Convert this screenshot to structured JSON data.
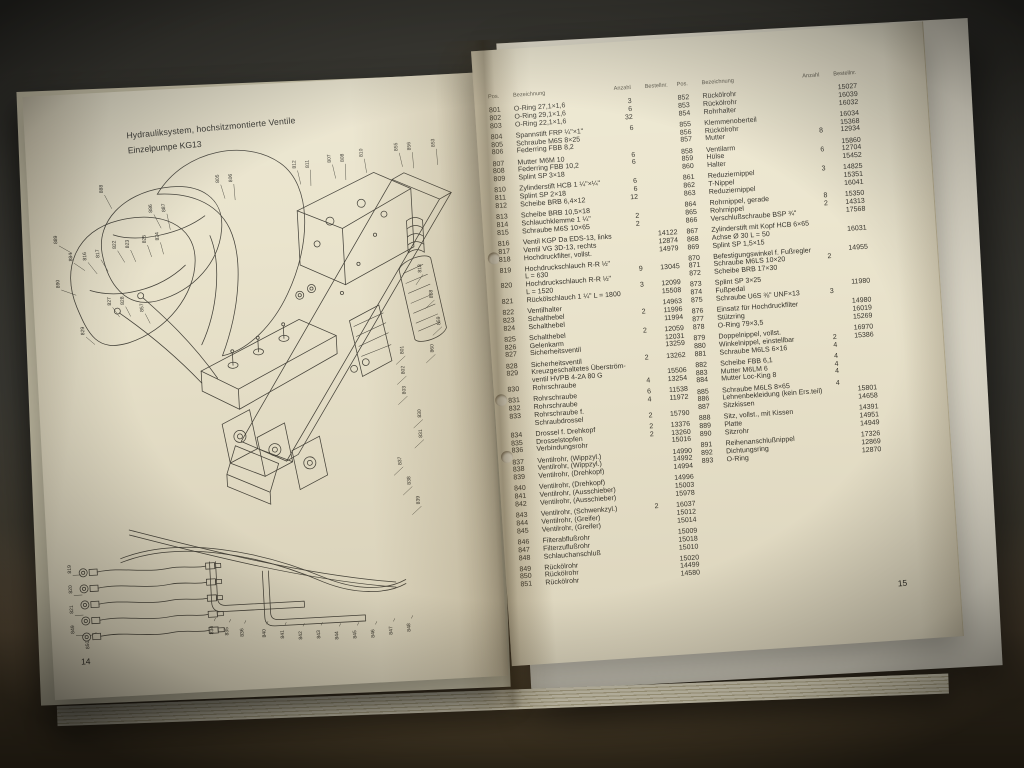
{
  "photo": {
    "background_color": "#3c3b35",
    "table_surface_color": "#6b5a42",
    "page_color": "#eae4cd"
  },
  "left_page": {
    "heading_line1": "Hydrauliksystem, hochsitzmontierte Ventile",
    "heading_line2": "Einzelpumpe KG13",
    "page_number": "14",
    "diagram_callouts": [
      {
        "x": 62,
        "y": 56,
        "t": "888",
        "lx": 8,
        "ly": 16
      },
      {
        "x": 110,
        "y": 78,
        "t": "886",
        "lx": 8,
        "ly": 16
      },
      {
        "x": 123,
        "y": 78,
        "t": "887",
        "lx": 4,
        "ly": 18
      },
      {
        "x": 178,
        "y": 52,
        "t": "805",
        "lx": 5,
        "ly": 16
      },
      {
        "x": 191,
        "y": 52,
        "t": "806",
        "lx": 2,
        "ly": 18
      },
      {
        "x": 255,
        "y": 42,
        "t": "812",
        "lx": 4,
        "ly": 16
      },
      {
        "x": 268,
        "y": 42,
        "t": "811",
        "lx": 1,
        "ly": 18
      },
      {
        "x": 290,
        "y": 38,
        "t": "807",
        "lx": 4,
        "ly": 16
      },
      {
        "x": 303,
        "y": 38,
        "t": "808",
        "lx": 1,
        "ly": 18
      },
      {
        "x": 322,
        "y": 34,
        "t": "810",
        "lx": 3,
        "ly": 16
      },
      {
        "x": 357,
        "y": 30,
        "t": "855",
        "lx": 4,
        "ly": 16
      },
      {
        "x": 370,
        "y": 30,
        "t": "856",
        "lx": 2,
        "ly": 18
      },
      {
        "x": 394,
        "y": 28,
        "t": "853",
        "lx": 2,
        "ly": 18
      },
      {
        "x": 14,
        "y": 104,
        "t": "889",
        "lx": 14,
        "ly": 10
      },
      {
        "x": 14,
        "y": 148,
        "t": "890",
        "lx": 16,
        "ly": 8
      },
      {
        "x": 28,
        "y": 122,
        "t": "884",
        "lx": 12,
        "ly": 10
      },
      {
        "x": 42,
        "y": 122,
        "t": "816",
        "lx": 10,
        "ly": 14
      },
      {
        "x": 55,
        "y": 120,
        "t": "817",
        "lx": 8,
        "ly": 14
      },
      {
        "x": 72,
        "y": 112,
        "t": "822",
        "lx": 8,
        "ly": 14
      },
      {
        "x": 85,
        "y": 112,
        "t": "823",
        "lx": 6,
        "ly": 14
      },
      {
        "x": 102,
        "y": 108,
        "t": "825",
        "lx": 5,
        "ly": 14
      },
      {
        "x": 115,
        "y": 106,
        "t": "824",
        "lx": 4,
        "ly": 14
      },
      {
        "x": 64,
        "y": 168,
        "t": "827",
        "lx": 8,
        "ly": 12
      },
      {
        "x": 77,
        "y": 168,
        "t": "828",
        "lx": 6,
        "ly": 12
      },
      {
        "x": 96,
        "y": 176,
        "t": "857",
        "lx": 6,
        "ly": 12
      },
      {
        "x": 36,
        "y": 196,
        "t": "829",
        "lx": 10,
        "ly": 10
      },
      {
        "x": 374,
        "y": 152,
        "t": "818",
        "lx": -6,
        "ly": 12
      },
      {
        "x": 384,
        "y": 178,
        "t": "858",
        "lx": -8,
        "ly": 10
      },
      {
        "x": 390,
        "y": 205,
        "t": "859",
        "lx": -8,
        "ly": 10
      },
      {
        "x": 382,
        "y": 232,
        "t": "860",
        "lx": -8,
        "ly": 10
      },
      {
        "x": 352,
        "y": 232,
        "t": "801",
        "lx": -8,
        "ly": 10
      },
      {
        "x": 352,
        "y": 252,
        "t": "802",
        "lx": -8,
        "ly": 10
      },
      {
        "x": 352,
        "y": 272,
        "t": "803",
        "lx": -8,
        "ly": 10
      },
      {
        "x": 366,
        "y": 296,
        "t": "830",
        "lx": -8,
        "ly": 10
      },
      {
        "x": 366,
        "y": 316,
        "t": "831",
        "lx": -8,
        "ly": 10
      },
      {
        "x": 344,
        "y": 342,
        "t": "837",
        "lx": -8,
        "ly": 10
      },
      {
        "x": 352,
        "y": 362,
        "t": "838",
        "lx": -8,
        "ly": 10
      },
      {
        "x": 360,
        "y": 382,
        "t": "839",
        "lx": -8,
        "ly": 10
      },
      {
        "x": 10,
        "y": 432,
        "t": "819",
        "lx": 10,
        "ly": 2
      },
      {
        "x": 10,
        "y": 452,
        "t": "820",
        "lx": 10,
        "ly": 2
      },
      {
        "x": 10,
        "y": 472,
        "t": "821",
        "lx": 10,
        "ly": 2
      },
      {
        "x": 10,
        "y": 492,
        "t": "849",
        "lx": 10,
        "ly": 2
      },
      {
        "x": 24,
        "y": 508,
        "t": "850",
        "lx": 8,
        "ly": -16
      },
      {
        "x": 148,
        "y": 500,
        "t": "834",
        "lx": 3,
        "ly": -16
      },
      {
        "x": 163,
        "y": 502,
        "t": "835",
        "lx": 3,
        "ly": -16
      },
      {
        "x": 178,
        "y": 504,
        "t": "836",
        "lx": 3,
        "ly": -16
      },
      {
        "x": 200,
        "y": 506,
        "t": "840",
        "lx": 3,
        "ly": -16
      },
      {
        "x": 218,
        "y": 508,
        "t": "841",
        "lx": 3,
        "ly": -16
      },
      {
        "x": 236,
        "y": 510,
        "t": "842",
        "lx": 3,
        "ly": -16
      },
      {
        "x": 254,
        "y": 510,
        "t": "843",
        "lx": 3,
        "ly": -16
      },
      {
        "x": 272,
        "y": 512,
        "t": "844",
        "lx": 3,
        "ly": -16
      },
      {
        "x": 290,
        "y": 512,
        "t": "845",
        "lx": 3,
        "ly": -16
      },
      {
        "x": 308,
        "y": 512,
        "t": "846",
        "lx": 3,
        "ly": -16
      },
      {
        "x": 326,
        "y": 510,
        "t": "847",
        "lx": 3,
        "ly": -16
      },
      {
        "x": 344,
        "y": 508,
        "t": "848",
        "lx": 3,
        "ly": -16
      }
    ]
  },
  "right_page": {
    "page_number": "15",
    "table": {
      "headers": {
        "pos": "Pos.",
        "name": "Bezeichnung",
        "qty": "Anzahl",
        "no": "Bestellnr."
      },
      "col1_groups": [
        [
          [
            "801",
            "O-Ring 27,1×1,6",
            "",
            "3",
            ""
          ],
          [
            "802",
            "O-Ring 29,1×1,6",
            "",
            "6",
            ""
          ],
          [
            "803",
            "O-Ring 22,1×1,6",
            "",
            "32",
            ""
          ]
        ],
        [
          [
            "804",
            "Spannstift FRP ¼\"×1\"",
            "",
            "6",
            ""
          ],
          [
            "805",
            "Schraube M6S 8×25",
            "",
            "",
            ""
          ],
          [
            "806",
            "Federring FBB 8,2",
            "",
            "",
            ""
          ]
        ],
        [
          [
            "807",
            "Mutter M6M 10",
            "",
            "6",
            ""
          ],
          [
            "808",
            "Federring FBB 10,2",
            "",
            "6",
            ""
          ],
          [
            "809",
            "Splint SP 3×18",
            "",
            "",
            ""
          ]
        ],
        [
          [
            "810",
            "Zylinderstift HCB 1 ¼\"×¼\"",
            "",
            "6",
            ""
          ],
          [
            "811",
            "Splint SP 2×18",
            "",
            "6",
            ""
          ],
          [
            "812",
            "Scheibe BRB 6,4×12",
            "",
            "12",
            ""
          ]
        ],
        [
          [
            "813",
            "Scheibe BRB 10,5×18",
            "",
            "",
            ""
          ],
          [
            "814",
            "Schlauchklemme 1 ¼\"",
            "",
            "2",
            ""
          ],
          [
            "815",
            "Schraube M6S 10×65",
            "",
            "2",
            ""
          ]
        ],
        [
          [
            "816",
            "Ventil KGP Da EDS-13, links",
            "",
            "",
            "14122"
          ],
          [
            "817",
            "Ventil VG 3D-13, rechts",
            "",
            "",
            "12874"
          ],
          [
            "818",
            "Hochdruckfilter, vollst.",
            "",
            "",
            "14979"
          ]
        ],
        [
          [
            "819",
            "Hochdruckschlauch R-R ½\"",
            "L = 630",
            "9",
            "13045"
          ],
          [
            "820",
            "Hochdruckschlauch R-R ½\"",
            "L = 1520",
            "3",
            "12099"
          ],
          [
            "821",
            "Rückölschlauch 1 ¼\" L = 1800",
            "",
            "",
            "15508"
          ]
        ],
        [
          [
            "822",
            "Ventilhalter",
            "",
            "",
            "14963"
          ],
          [
            "823",
            "Schalthebel",
            "",
            "2",
            "11996"
          ],
          [
            "824",
            "Schalthebel",
            "",
            "",
            "11994"
          ]
        ],
        [
          [
            "825",
            "Schalthebel",
            "",
            "2",
            "12059"
          ],
          [
            "826",
            "Gelenkarm",
            "",
            "",
            "12031"
          ],
          [
            "827",
            "Sicherheitsventil",
            "",
            "",
            "13259"
          ]
        ],
        [
          [
            "828",
            "Sicherheitsventil",
            "",
            "2",
            "13262"
          ],
          [
            "829",
            "Kreuzgeschaltetes Überström-",
            "ventil HVPB 4-2A 80 G",
            "",
            "15506"
          ],
          [
            "830",
            "Rohrschraube",
            "",
            "4",
            "13254"
          ]
        ],
        [
          [
            "831",
            "Rohrschraube",
            "",
            "6",
            "11538"
          ],
          [
            "832",
            "Rohrschraube",
            "",
            "4",
            "11972"
          ],
          [
            "833",
            "Rohrschraube f.",
            "Schraubdrossel",
            "2",
            "15790"
          ]
        ],
        [
          [
            "834",
            "Drossel f. Drehkopf",
            "",
            "2",
            "13376"
          ],
          [
            "835",
            "Drosselstopfen",
            "",
            "2",
            "13260"
          ],
          [
            "836",
            "Verbindungsrohr",
            "",
            "",
            "15016"
          ]
        ],
        [
          [
            "837",
            "Ventilrohr, (Wippzyl.)",
            "",
            "",
            "14990"
          ],
          [
            "838",
            "Ventilrohr, (Wippzyl.)",
            "",
            "",
            "14992"
          ],
          [
            "839",
            "Ventilrohr, (Drehkopf)",
            "",
            "",
            "14994"
          ]
        ],
        [
          [
            "840",
            "Ventilrohr, (Drehkopf)",
            "",
            "",
            "14996"
          ],
          [
            "841",
            "Ventilrohr, (Ausschieber)",
            "",
            "",
            "15003"
          ],
          [
            "842",
            "Ventilrohr, (Ausschieber)",
            "",
            "",
            "15978"
          ]
        ],
        [
          [
            "843",
            "Ventilrohr, (Schwenkzyl.)",
            "",
            "2",
            "16037"
          ],
          [
            "844",
            "Ventilrohr, (Greifer)",
            "",
            "",
            "15012"
          ],
          [
            "845",
            "Ventilrohr, (Greifer)",
            "",
            "",
            "15014"
          ]
        ],
        [
          [
            "846",
            "Filterabflußrohr",
            "",
            "",
            "15009"
          ],
          [
            "847",
            "Filterzuflußrohr",
            "",
            "",
            "15018"
          ],
          [
            "848",
            "Schlauchanschluß",
            "",
            "",
            "15010"
          ]
        ],
        [
          [
            "849",
            "Rückölrohr",
            "",
            "",
            "15020"
          ],
          [
            "850",
            "Rückölrohr",
            "",
            "",
            "14499"
          ],
          [
            "851",
            "Rückölrohr",
            "",
            "",
            "14580"
          ]
        ]
      ],
      "col2_groups": [
        [
          [
            "852",
            "Rückölrohr",
            "",
            "",
            "15027"
          ],
          [
            "853",
            "Rückölrohr",
            "",
            "",
            "16039"
          ],
          [
            "854",
            "Rohrhalter",
            "",
            "",
            "16032"
          ]
        ],
        [
          [
            "855",
            "Klemmenoberteil",
            "",
            "",
            "16034"
          ],
          [
            "856",
            "Rückölrohr",
            "",
            "",
            "15368"
          ],
          [
            "857",
            "Mutter",
            "",
            "8",
            "12934"
          ]
        ],
        [
          [
            "858",
            "Ventilarm",
            "",
            "",
            "15860"
          ],
          [
            "859",
            "Hülse",
            "",
            "6",
            "12704"
          ],
          [
            "860",
            "Halter",
            "",
            "",
            "15452"
          ]
        ],
        [
          [
            "861",
            "Reduziernippel",
            "",
            "3",
            "14825"
          ],
          [
            "862",
            "T-Nippel",
            "",
            "",
            "15351"
          ],
          [
            "863",
            "Reduziernippel",
            "",
            "",
            "16041"
          ]
        ],
        [
          [
            "864",
            "Rohrnippel, gerade",
            "",
            "8",
            "15350"
          ],
          [
            "865",
            "Rohrnippel",
            "",
            "2",
            "14313"
          ],
          [
            "866",
            "Verschlußschraube BSP ¾\"",
            "",
            "",
            "17568"
          ]
        ],
        [
          [
            "867",
            "Zylinderstift mit Kopf HCB 6×65",
            "",
            "",
            ""
          ],
          [
            "868",
            "Achse Ø 30 L = 50",
            "",
            "",
            "16031"
          ],
          [
            "869",
            "Splint SP 1,5×15",
            "",
            "",
            ""
          ]
        ],
        [
          [
            "870",
            "Befestigungswinkel f. Fußregler",
            "",
            "",
            "14955"
          ],
          [
            "871",
            "Schraube M6LS 10×20",
            "",
            "2",
            ""
          ],
          [
            "872",
            "Scheibe BRB 17×30",
            "",
            "",
            ""
          ]
        ],
        [
          [
            "873",
            "Splint SP 3×25",
            "",
            "",
            ""
          ],
          [
            "874",
            "Fußpedal",
            "",
            "",
            "11980"
          ],
          [
            "875",
            "Schraube U6S ⅜\" UNF×13",
            "",
            "3",
            ""
          ]
        ],
        [
          [
            "876",
            "Einsatz für Hochdruckfilter",
            "",
            "",
            "14980"
          ],
          [
            "877",
            "Stützring",
            "",
            "",
            "16019"
          ],
          [
            "878",
            "O-Ring 79×3,5",
            "",
            "",
            "15269"
          ]
        ],
        [
          [
            "879",
            "Doppelnippel, vollst.",
            "",
            "",
            "16970"
          ],
          [
            "880",
            "Winkelnippel, einstellbar",
            "",
            "2",
            "15386"
          ],
          [
            "881",
            "Schraube M6LS 6×16",
            "",
            "4",
            ""
          ]
        ],
        [
          [
            "882",
            "Scheibe FBB 6,1",
            "",
            "4",
            ""
          ],
          [
            "883",
            "Mutter M6LM 6",
            "",
            "4",
            ""
          ],
          [
            "884",
            "Mutter Loc-King 8",
            "",
            "4",
            ""
          ]
        ],
        [
          [
            "885",
            "Schraube M6LS 8×65",
            "",
            "4",
            ""
          ],
          [
            "886",
            "Lehnenbekleidung (kein Ers.teil)",
            "",
            "",
            "15801"
          ],
          [
            "887",
            "Sitzkissen",
            "",
            "",
            "14658"
          ]
        ],
        [
          [
            "888",
            "Sitz, vollst., mit Kissen",
            "",
            "",
            "14391"
          ],
          [
            "889",
            "Platte",
            "",
            "",
            "14951"
          ],
          [
            "890",
            "Sitzrohr",
            "",
            "",
            "14949"
          ]
        ],
        [
          [
            "891",
            "Reihenanschlußnippel",
            "",
            "",
            "17326"
          ],
          [
            "892",
            "Dichtungsring",
            "",
            "",
            "12869"
          ],
          [
            "893",
            "O-Ring",
            "",
            "",
            "12870"
          ]
        ]
      ]
    }
  }
}
